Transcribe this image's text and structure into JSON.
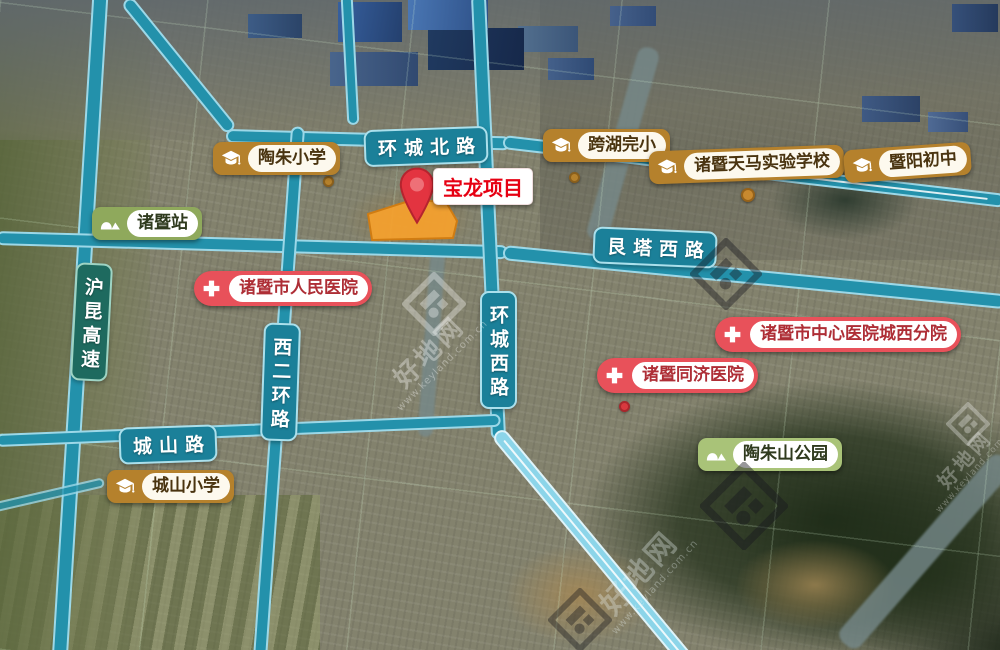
{
  "title": "宝龙项目区位图",
  "project": {
    "label": "宝龙项目"
  },
  "roads": {
    "north_ring": "环城北路",
    "genta_west": "艮塔西路",
    "west_ring": "环城西路",
    "second_west_ring": "西二环路",
    "chengshan": "城山路",
    "hukun_expressway": "沪昆高速"
  },
  "pois": {
    "station": {
      "label": "诸暨站"
    },
    "schools": [
      {
        "label": "陶朱小学"
      },
      {
        "label": "跨湖完小"
      },
      {
        "label": "诸暨天马实验学校"
      },
      {
        "label": "暨阳初中"
      },
      {
        "label": "城山小学"
      }
    ],
    "hospitals": [
      {
        "label": "诸暨市人民医院"
      },
      {
        "label": "诸暨市中心医院城西分院"
      },
      {
        "label": "诸暨同济医院"
      }
    ],
    "park": {
      "label": "陶朱山公园"
    }
  },
  "watermark": {
    "brand": "好地网",
    "url": "www.keyland.com.cn"
  },
  "icons": {
    "school": "graduation-cap",
    "hospital": "medical-cross",
    "station": "landscape-mountains",
    "park": "landscape-mountains",
    "project": "location-pin",
    "watermark": "haodi-diamond-logo"
  },
  "colors": {
    "road_teal": "#2391ab",
    "road_bright": "#8cd5e9",
    "road_label_bg": "#1b8099",
    "expressway_label_bg": "#1e6a5f",
    "school_badge": "#b5812c",
    "hospital_badge": "#e8515a",
    "station_badge": "#8fa95c",
    "park_badge": "#a9c378",
    "project_text_red": "#e60012",
    "site_orange": "#f3a02e"
  }
}
